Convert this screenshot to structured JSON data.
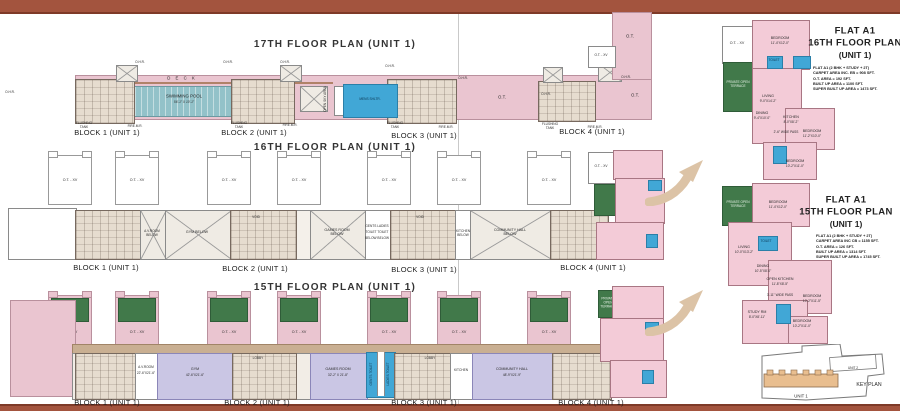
{
  "colors": {
    "bar": "#A3543E",
    "bar_edge": "#7E3A28",
    "pink": "#EAC5D0",
    "flat_pink": "#F3CBD7",
    "teal": "#93C2C9",
    "green": "#41794A",
    "lavender": "#CAC6E4",
    "blue": "#41A7D6",
    "tan": "#C9AF92",
    "tan_light": "#E6DCCF",
    "arrow": "#DCC3A6"
  },
  "shared": {
    "ot_xv": "O.T. - XV",
    "ot": "O.T.",
    "ohr": "O.H.R.",
    "void": "VOID",
    "lobby": "LOBBY",
    "flushing_tank": "FLUSHING TANK",
    "fire_mr": "FIRE.M.R.",
    "private_open_terrace": "PRIVATE OPEN TERRACE",
    "toilet": "TOILET",
    "block_labels": [
      "BLOCK 1 (UNIT 1)",
      "BLOCK 2 (UNIT 1)",
      "BLOCK 3 (UNIT 1)",
      "BLOCK 4 (UNIT 1)"
    ]
  },
  "floor17": {
    "title": "17TH FLOOR PLAN (UNIT 1)",
    "deck": "D E C K",
    "pool_name": "SWIMMING POOL",
    "pool_size": "56'-1\" X 10'-1\"",
    "mens_shltr": "MENS SHLTR.",
    "open_sky": "OPEN SKY AREA"
  },
  "floor16": {
    "title": "16TH FLOOR PLAN (UNIT 1)",
    "av_room": "A.V.ROOM BELOW",
    "gym": "GYM BELOW",
    "games": "GAMES ROOM BELOW",
    "toilets_l1": "GENTS LADIES",
    "toilets_l2": "TOILET TOILET",
    "toilets_l3": "BELOW BELOW",
    "kitchen": "KITCHEN BELOW",
    "community": "COMMUNITY HALL BELOW"
  },
  "floor15": {
    "title": "15TH FLOOR PLAN (UNIT 1)",
    "av_room": "A.V.ROOM",
    "av_size": "22'-6\"X21'-6\"",
    "gym": "GYM",
    "gym_size": "42'-6\"X21'-6\"",
    "games": "GAMES ROOM",
    "games_size": "32'-2\" X 21'-8\"",
    "kitchen": "KITCHEN",
    "community": "COMMUNITY HALL",
    "community_size": "48'-9\"X21'-9\"",
    "gents": "GENTS TOILET",
    "ladies": "LADIES TOILET"
  },
  "flat16": {
    "t1": "FLAT A1",
    "t2": "16TH FLOOR PLAN",
    "t3": "(UNIT 1)",
    "specs": [
      "FLAT A1 (2 BHK + STUDY + 2T)",
      "CARPET AREA INC. EB = 908 SFT.",
      "O.T. AREA = 192 SFT.",
      "BUILT UP AREA = 1100 SFT.",
      "SUPER BUILT UP AREA = 1473 SFT."
    ],
    "rooms": {
      "bedroom1": "BEDROOM",
      "bedroom1_size": "11'-4\"X12'-0\"",
      "living": "LIVING",
      "living_size": "9'-0\"X14'-2\"",
      "dining": "DINING",
      "dining_size": "9'-4\"X10'-0\"",
      "kitchen": "KITCHEN",
      "kitchen_size": "8'-0\"X8'-2\"",
      "pass": "2'-6\" WIDE PASS",
      "bedroom2": "BEDROOM",
      "bedroom2_size": "11'-2\"X10'-0\"",
      "bedroom3": "BEDROOM",
      "bedroom3_size": "10'-2\"X11'-0\""
    }
  },
  "flat15": {
    "t1": "FLAT A1",
    "t2": "15TH FLOOR PLAN",
    "t3": "(UNIT 1)",
    "specs": [
      "FLAT A1 (2 BHK + STUDY + 2T)",
      "CARPET AREA INC CB = 1155 SFT.",
      "O.T. AREA = 126 SFT.",
      "BUILT UP AREA = 1314 SFT.",
      "SUPER BUILT UP AREA = 1745 SFT."
    ],
    "rooms": {
      "bedroom1": "BEDROOM",
      "bedroom1_size": "11'-4\"X12'-0\"",
      "living": "LIVING",
      "living_size": "10'-0\"X13'-2\"",
      "dining": "DINING",
      "dining_size": "10'-5\"X8'-0\"",
      "open_kitchen": "OPEN KITCHEN",
      "open_kitchen_size": "11'-8\"X8'-5\"",
      "pass": "3'-11\" WIDE PASS",
      "bedroom2": "BEDROOM",
      "bedroom2_size": "10'-2\"X11'-5\"",
      "bedroom3": "BEDROOM",
      "bedroom3_size": "10'-2\"X11'-0\"",
      "study": "STUDY RM",
      "study_size": "8'-0\"X8'-11\""
    }
  },
  "keyplan": {
    "label": "KEY PLAN",
    "unit1": "UNIT 1",
    "unit2": "UNIT 2"
  }
}
